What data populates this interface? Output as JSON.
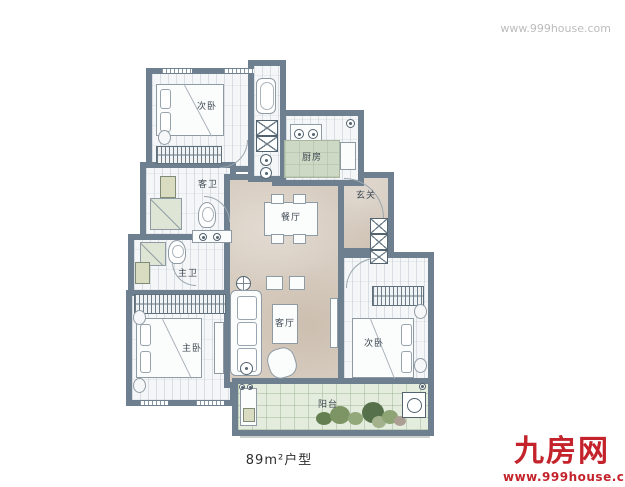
{
  "watermark": {
    "top_right": "www.999house.com"
  },
  "caption": "89m²户型",
  "logo": {
    "name": "九房网",
    "url": "www.999house.com",
    "color": "#c4232b"
  },
  "plan": {
    "labels": {
      "bedroom_top": "次卧",
      "bathroom_guest": "客卫",
      "kitchen": "厨房",
      "dining": "餐厅",
      "entry": "玄关",
      "bathroom_master": "主卫",
      "living": "客厅",
      "bedroom_master": "主卧",
      "bedroom_right": "次卧",
      "balcony": "阳台"
    },
    "colors": {
      "wall": "#6e8090",
      "room_floor": "#f5f6f7",
      "hall_floor": "#d7ccc0",
      "balcony_floor": "#e4ecdd",
      "kitchen_island": "#ced9c5",
      "label_text": "#3d4852"
    }
  }
}
